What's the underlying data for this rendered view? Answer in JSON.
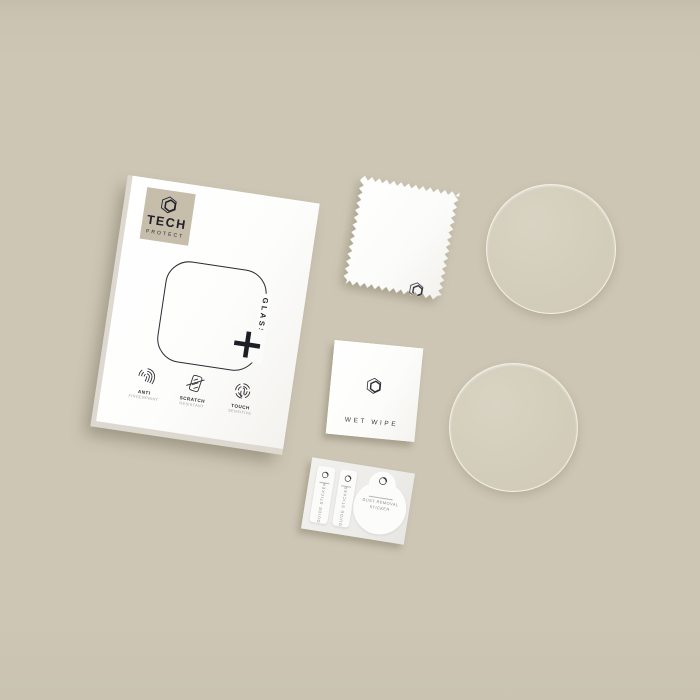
{
  "photo": {
    "colors": {
      "background": "#cdc6b4",
      "box_face": "#ffffff",
      "brand_patch": "#c6bdaa",
      "ink": "#23232c",
      "glass_disc_fill": "#d3cdbb"
    },
    "box": {
      "brand_name": "TECH",
      "brand_subname": "PROTECT",
      "product_line": "GLASS FIT",
      "plus_symbol": "+",
      "features": [
        {
          "icon": "fingerprint-icon",
          "title": "ANTI",
          "subtitle": "FINGERPRINT"
        },
        {
          "icon": "scratch-icon",
          "title": "SCRATCH",
          "subtitle": "RESISTANT"
        },
        {
          "icon": "touch-icon",
          "title": "TOUCH",
          "subtitle": "SENSITIVE"
        }
      ]
    },
    "wet_wipe": {
      "label": "WET WIPE"
    },
    "sticker_sheet": {
      "guide_sticker_labels": [
        "GUIDE STICKER",
        "GUIDE STICKER"
      ],
      "dust_removal_line1": "DUST REMOVAL",
      "dust_removal_line2": "STICKER"
    }
  }
}
